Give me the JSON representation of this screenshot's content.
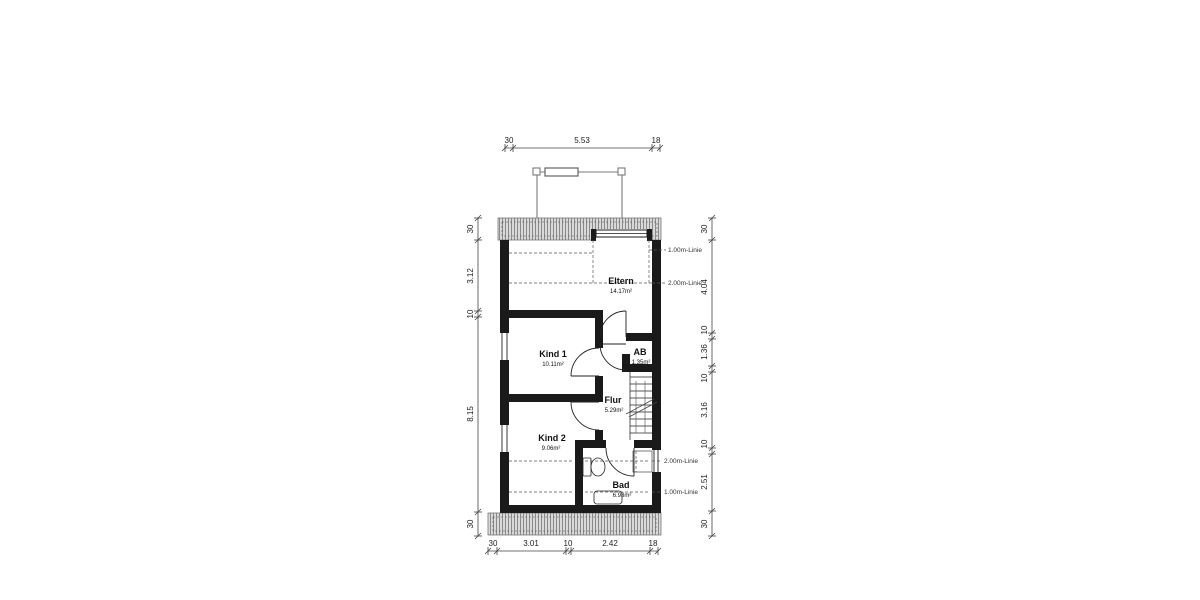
{
  "rooms": {
    "eltern": {
      "name": "Eltern",
      "area": "14.17m²"
    },
    "kind1": {
      "name": "Kind 1",
      "area": "10.11m²"
    },
    "ab": {
      "name": "AB",
      "area": "1.35m²"
    },
    "flur": {
      "name": "Flur",
      "area": "5.29m²"
    },
    "kind2": {
      "name": "Kind 2",
      "area": "9.06m²"
    },
    "bad": {
      "name": "Bad",
      "area": "6.98m²"
    }
  },
  "height_lines": {
    "top_1m": "1.00m-Linie",
    "top_2m": "2.00m-Linie",
    "bottom_2m": "2.00m-Linie",
    "bottom_1m": "1.00m-Linie"
  },
  "dimensions": {
    "top": [
      "30",
      "5.53",
      "18"
    ],
    "bottom": [
      "30",
      "3.01",
      "10",
      "2.42",
      "18"
    ],
    "left": [
      "30",
      "3.12",
      "10",
      "8.15",
      "30"
    ],
    "right": [
      "30",
      "4.04",
      "10",
      "1.36",
      "10",
      "3.16",
      "10",
      "2.51",
      "30"
    ]
  },
  "colors": {
    "wall": "#1a1a1a",
    "hatch_bg": "#d9d9d9",
    "hatch_line": "#8a8a8a",
    "thin_line": "#333333",
    "gray_line": "#888888"
  }
}
